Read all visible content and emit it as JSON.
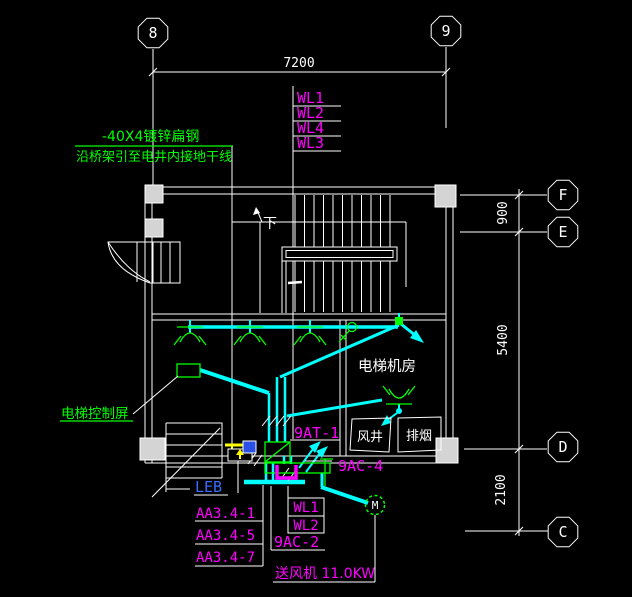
{
  "labels": {
    "grid_top": [
      "8",
      "9"
    ],
    "grid_right": [
      "F",
      "E",
      "D",
      "C"
    ],
    "dims": {
      "top": "7200",
      "r900": "900",
      "r5400": "5400",
      "r2100": "2100"
    },
    "ground_note_line1": "-40X4镀锌扁钢",
    "ground_note_line2": "沿桥架引至电井内接地干线",
    "riser_circuits": [
      "WL1",
      "WL2",
      "WL4",
      "WL3"
    ],
    "stair_down": "下",
    "room_machine": "电梯机房",
    "shaft_air": "风井",
    "shaft_smoke": "排烟",
    "elevator_control_panel": "电梯控制屏",
    "panel_at1": "9AT-1",
    "panel_ac4": "9AC-4",
    "panel_ac2": "9AC-2",
    "leb": "LEB",
    "feeder_circuits": [
      "AA3.4-1",
      "AA3.4-5",
      "AA3.4-7"
    ],
    "fan_circuits": [
      "WL1",
      "WL2"
    ],
    "fan_note": "送风机 11.0KW",
    "motor": "M"
  },
  "colors": {
    "background": "#000000",
    "drawing_lines": "#FFFFFF",
    "wiring": "#00FFFF",
    "equipment": "#00FF00",
    "circuit_text": "#FF00FF",
    "leb_text": "#3A6BFF",
    "bonding_wire": "#FFFF00",
    "column_fill": "#D4D4D4"
  }
}
